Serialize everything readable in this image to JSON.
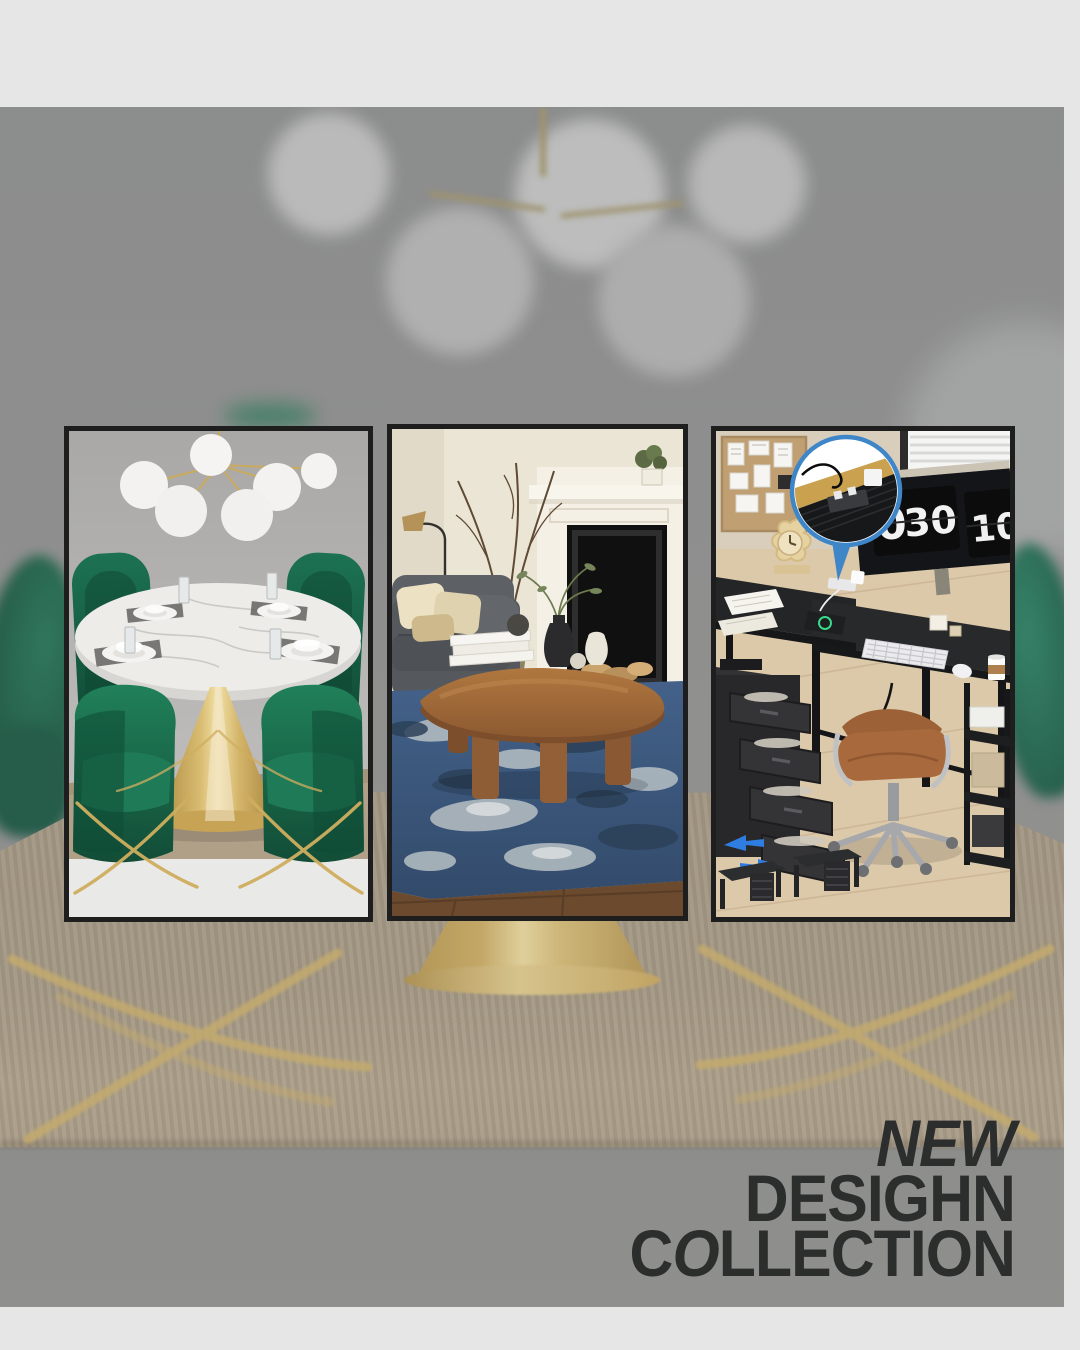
{
  "headline": {
    "line1": "NEW",
    "line2": "DESIGHN",
    "line3_c": "C",
    "line3_o": "O",
    "line3_rest": "LLECTION"
  },
  "desk_panel": {
    "flip_clock_left_hour": "0",
    "flip_clock_left_minutes": "30",
    "flip_clock_right": "10"
  },
  "icons": {
    "reversible_arrows": "reversible-arrows-icon",
    "callout_bubble": "power-strip-callout-bubble"
  },
  "colors": {
    "headline_text": "#2C2D2D",
    "frame_background": "#E5E6E5",
    "photo_overlay_gray": "#8F9090",
    "panel_border": "#1E1E1E",
    "velvet_green": "#1B6B4E",
    "brass_gold": "#CDAF63",
    "marble_white": "#ECEBE8",
    "dining_rug_beige": "#A3957E",
    "living_rug_blue": "#3F5D7D",
    "desk_black": "#242527",
    "callout_blue": "#3F86C9",
    "arrow_blue": "#2F7DE0",
    "chair_leather_brown": "#A8693C"
  }
}
